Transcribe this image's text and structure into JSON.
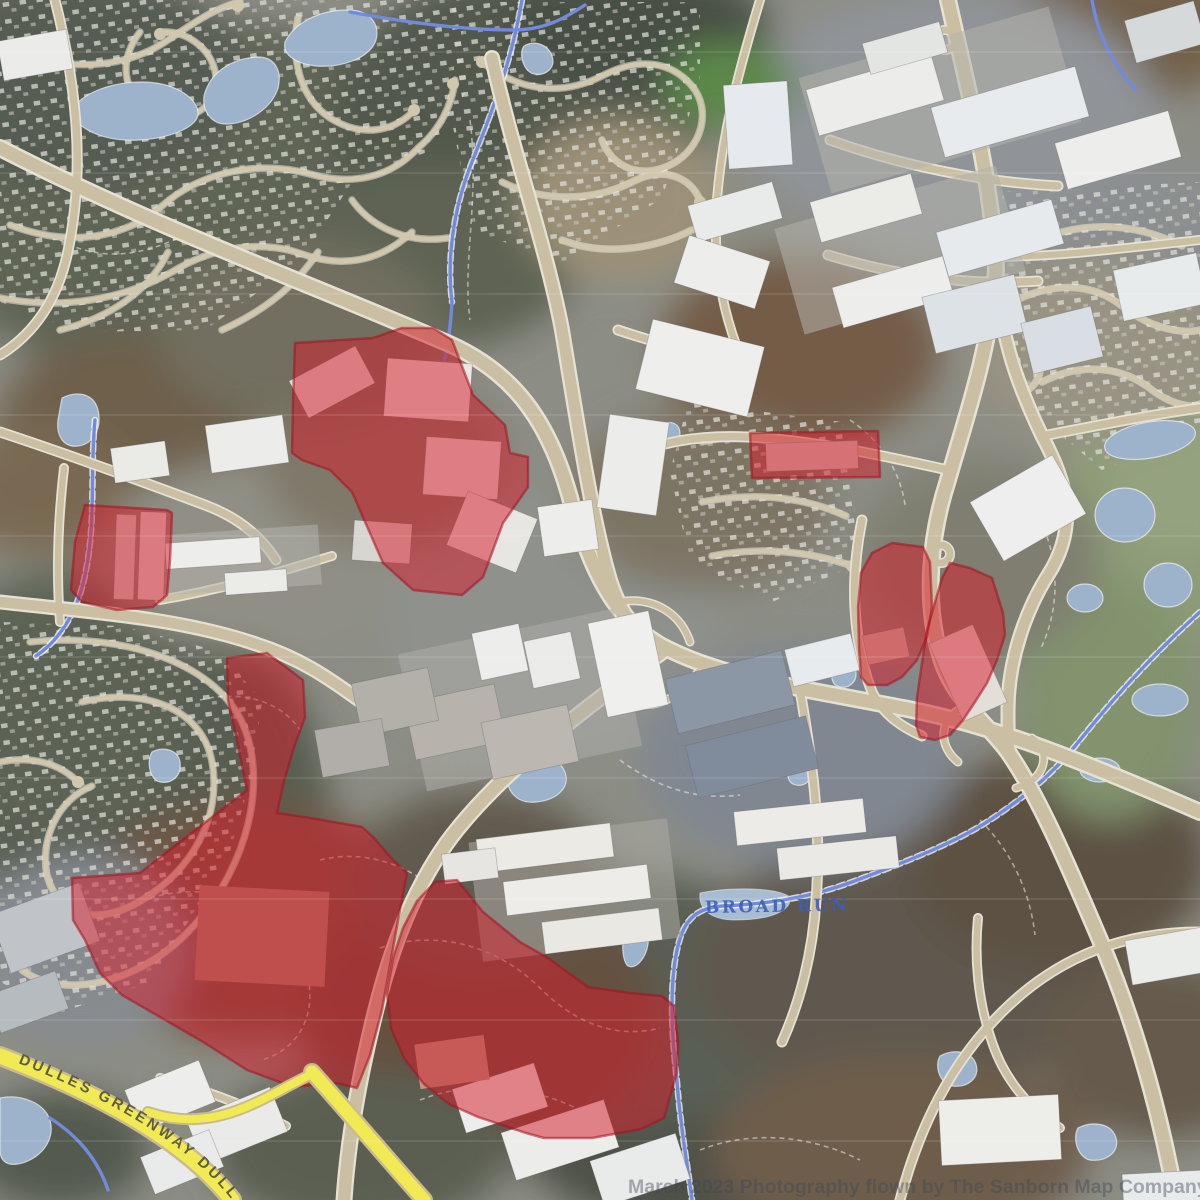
{
  "viewer": {
    "description": "aerial-orthophoto-map-with-zoning-overlay"
  },
  "labels": {
    "highway_label": "DULLES GREENWAY DULLES GREENWAY",
    "stream_label": "BROAD RUN",
    "watermark": "March 2023 Photography flown by The Sanborn Map Company, Inc."
  },
  "colors": {
    "zone_fill": "#d41f2c",
    "zone_fill_opacity": "0.52",
    "zone_stroke": "#a31220",
    "zone_stroke_opacity": "0.55",
    "water": "#9db4ce",
    "stream": "#6d87de",
    "road": "#cec0a1",
    "road_casing": "#ece6d5",
    "highway": "#f2ea55",
    "highway_label_color": "#5e5e40",
    "stream_label_color": "#3d5fb8",
    "watermark_color": "#3c4854"
  },
  "zones": [
    {
      "name": "zone-1",
      "points": "295,343 373,338 402,328 433,328 452,340 473,395 505,425 510,453 528,457 528,487 503,523 483,577 462,595 413,590 383,563 352,492 330,470 302,460 292,453 293,403"
    },
    {
      "name": "zone-2",
      "points": "85,505 167,510 172,513 170,560 167,595 153,607 117,610 82,602 71,590 75,542"
    },
    {
      "name": "zone-3",
      "points": "750,433 878,431 880,477 752,478"
    },
    {
      "name": "zone-4",
      "points": "892,543 923,547 930,562 932,607 927,637 917,660 902,677 887,685 868,685 861,677 859,647 858,607 861,573 872,553"
    },
    {
      "name": "zone-5",
      "points": "950,563 970,568 992,578 1003,613 1005,635 997,660 987,683 975,702 963,720 950,735 935,740 920,737 916,725 917,697 922,663 927,630 942,578"
    },
    {
      "name": "zone-6",
      "points": "227,658 267,653 303,680 305,717 293,750 283,785 277,813 310,818 362,827 373,837 393,860 407,873 398,920 390,965 382,1010 370,1055 357,1088 337,1083 293,1087 247,1070 200,1040 160,1017 122,995 100,973 85,940 73,920 72,878 140,873 193,832 247,790 237,740 228,700"
    },
    {
      "name": "zone-7",
      "points": "435,882 457,880 483,912 520,942 548,958 588,987 630,993 662,996 674,1006 678,1042 677,1072 664,1118 641,1129 592,1138 544,1138 526,1133 478,1117 449,1104 424,1084 404,1058 391,1028 387,993 393,958 403,928 417,901"
    }
  ]
}
